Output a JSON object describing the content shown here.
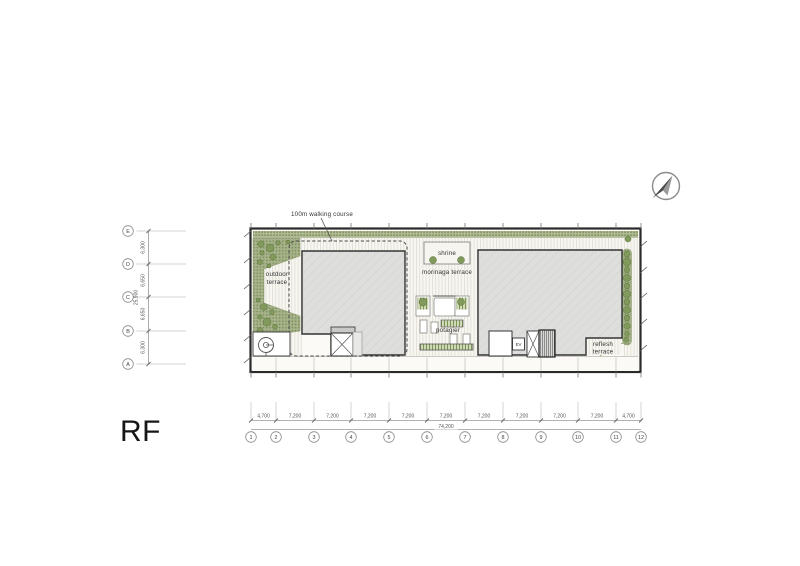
{
  "plan": {
    "floor_label": "RF",
    "annotations": {
      "walking_course": "100m walking course",
      "outdoor_terrace_line1": "outdoor",
      "outdoor_terrace_line2": "terrace",
      "shrine": "shrine",
      "morinaga_terrace": "morinaga terrace",
      "potagier": "potagier",
      "elevator": "EV",
      "reflesh_terrace_line1": "reflesh",
      "reflesh_terrace_line2": "terrace"
    }
  },
  "vertical_grid": {
    "labels": [
      "E",
      "D",
      "C",
      "B",
      "A"
    ],
    "spans": [
      "6,300",
      "6,650",
      "6,650",
      "6,300"
    ],
    "total": "25,900"
  },
  "horizontal_grid": {
    "labels": [
      "1",
      "2",
      "3",
      "4",
      "5",
      "6",
      "7",
      "8",
      "9",
      "10",
      "11",
      "12"
    ],
    "spans": [
      "4,700",
      "7,200",
      "7,200",
      "7,200",
      "7,200",
      "7,200",
      "7,200",
      "7,200",
      "7,200",
      "7,200",
      "4,700"
    ],
    "total": "74,200"
  },
  "colors": {
    "planting_green": "#a5b189",
    "bush_green": "#82995c",
    "building_gray": "#dedfdc",
    "boundary_dark": "#2a2a2a"
  }
}
